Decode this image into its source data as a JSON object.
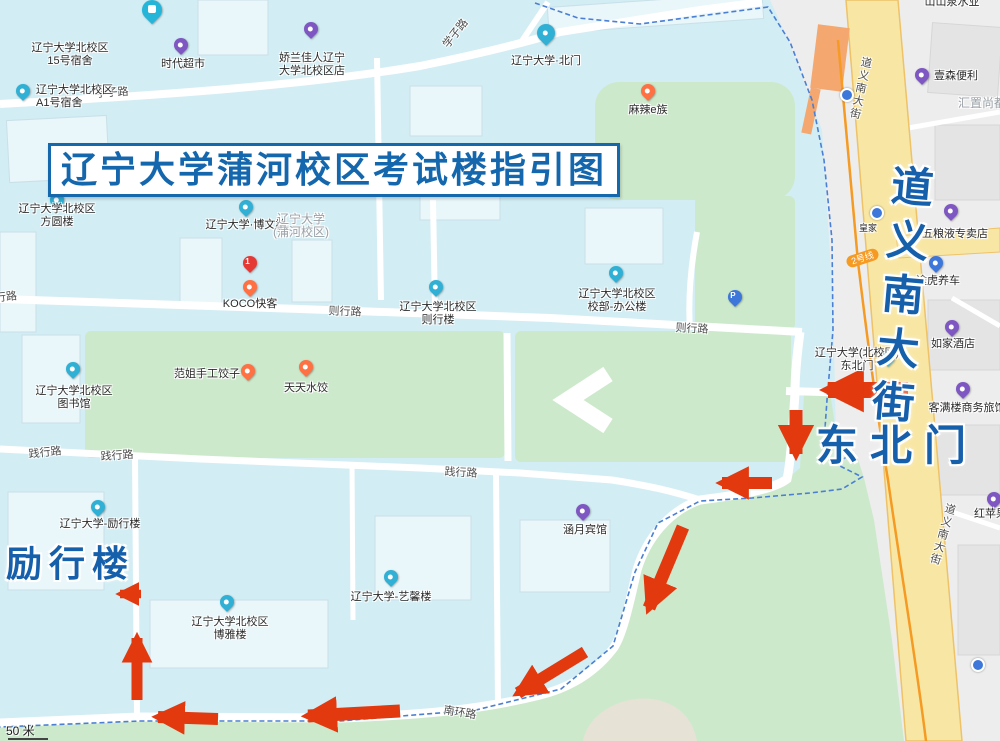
{
  "title": "辽宁大学蒲河校区考试楼指引图",
  "big_labels": {
    "northeast_gate": "东北门",
    "lixing": "励行楼",
    "street_vertical": "道义南大街"
  },
  "metro": {
    "badge": "2号线"
  },
  "scale": {
    "text": "50 米"
  },
  "glyphs": {
    "parking": "P",
    "koco_rank": "1"
  },
  "road_labels": [
    "学子路",
    "学子路",
    "则行路",
    "则行路",
    "则行路",
    "践行路",
    "践行路",
    "践行路",
    "南环路",
    "道义南大街",
    "道义南大街"
  ],
  "pois": [
    {
      "name": "dorm-15",
      "lines": [
        "辽宁大学北校区",
        "15号宿舍"
      ]
    },
    {
      "name": "shidai-supermarket",
      "lines": [
        "时代超市"
      ]
    },
    {
      "name": "jiaolanjiaren-store",
      "lines": [
        "娇兰佳人辽宁",
        "大学北校区店"
      ]
    },
    {
      "name": "north-gate",
      "lines": [
        "辽宁大学·北门"
      ]
    },
    {
      "name": "mala-e-zu",
      "lines": [
        "麻辣e族"
      ]
    },
    {
      "name": "fangyuan-building",
      "lines": [
        "辽宁大学北校区",
        "方圆楼"
      ]
    },
    {
      "name": "dorm-a1",
      "lines": [
        "辽宁大学北校区",
        "A1号宿舍"
      ]
    },
    {
      "name": "bowen-building",
      "lines": [
        "辽宁大学·博文楼"
      ]
    },
    {
      "name": "campus-name",
      "lines": [
        "辽宁大学",
        "(蒲河校区)"
      ]
    },
    {
      "name": "koco",
      "lines": [
        "KOCO快客"
      ]
    },
    {
      "name": "zexing-building",
      "lines": [
        "辽宁大学北校区",
        "则行楼"
      ]
    },
    {
      "name": "admin-office",
      "lines": [
        "辽宁大学北校区",
        "校部-办公楼"
      ]
    },
    {
      "name": "library",
      "lines": [
        "辽宁大学北校区",
        "图书馆"
      ]
    },
    {
      "name": "fanjie-dumplings",
      "lines": [
        "范姐手工饺子"
      ]
    },
    {
      "name": "tiantian-dumplings",
      "lines": [
        "天天水饺"
      ]
    },
    {
      "name": "lixing-building-poi",
      "lines": [
        "辽宁大学-励行楼"
      ]
    },
    {
      "name": "hanyue-hotel",
      "lines": [
        "涵月宾馆"
      ]
    },
    {
      "name": "yixin-building",
      "lines": [
        "辽宁大学-艺馨楼"
      ]
    },
    {
      "name": "boya-building",
      "lines": [
        "辽宁大学北校区",
        "博雅楼"
      ]
    },
    {
      "name": "northeast-gate-poi",
      "lines": [
        "辽宁大学(北校区)",
        "东北门"
      ]
    },
    {
      "name": "home-inn",
      "lines": [
        "如家酒店"
      ]
    },
    {
      "name": "wuliangye-store",
      "lines": [
        "五粮液专卖店"
      ]
    },
    {
      "name": "tuhu-car",
      "lines": [
        "途虎养车"
      ]
    },
    {
      "name": "kemanlou-hotel",
      "lines": [
        "客满楼商务旅馆"
      ]
    },
    {
      "name": "yisen-convenience",
      "lines": [
        "壹森便利"
      ]
    },
    {
      "name": "huizhi-shangdu",
      "lines": [
        "汇置尚都"
      ]
    },
    {
      "name": "shanshan-water",
      "lines": [
        "山山泉水业"
      ]
    },
    {
      "name": "red-apple",
      "lines": [
        "红苹果大"
      ]
    },
    {
      "name": "huangjia-stop",
      "lines": [
        "皇家"
      ]
    }
  ],
  "colors": {
    "campus_bg": "#d2edf4",
    "green": "#cde9cc",
    "urban_gray": "#ededed",
    "street_yellow": "#f8e7a4",
    "metro_orange": "#f59a23",
    "route_arrow": "#e2390f",
    "big_label_blue": "#155fab",
    "boundary_blue": "#4a7fd4"
  }
}
